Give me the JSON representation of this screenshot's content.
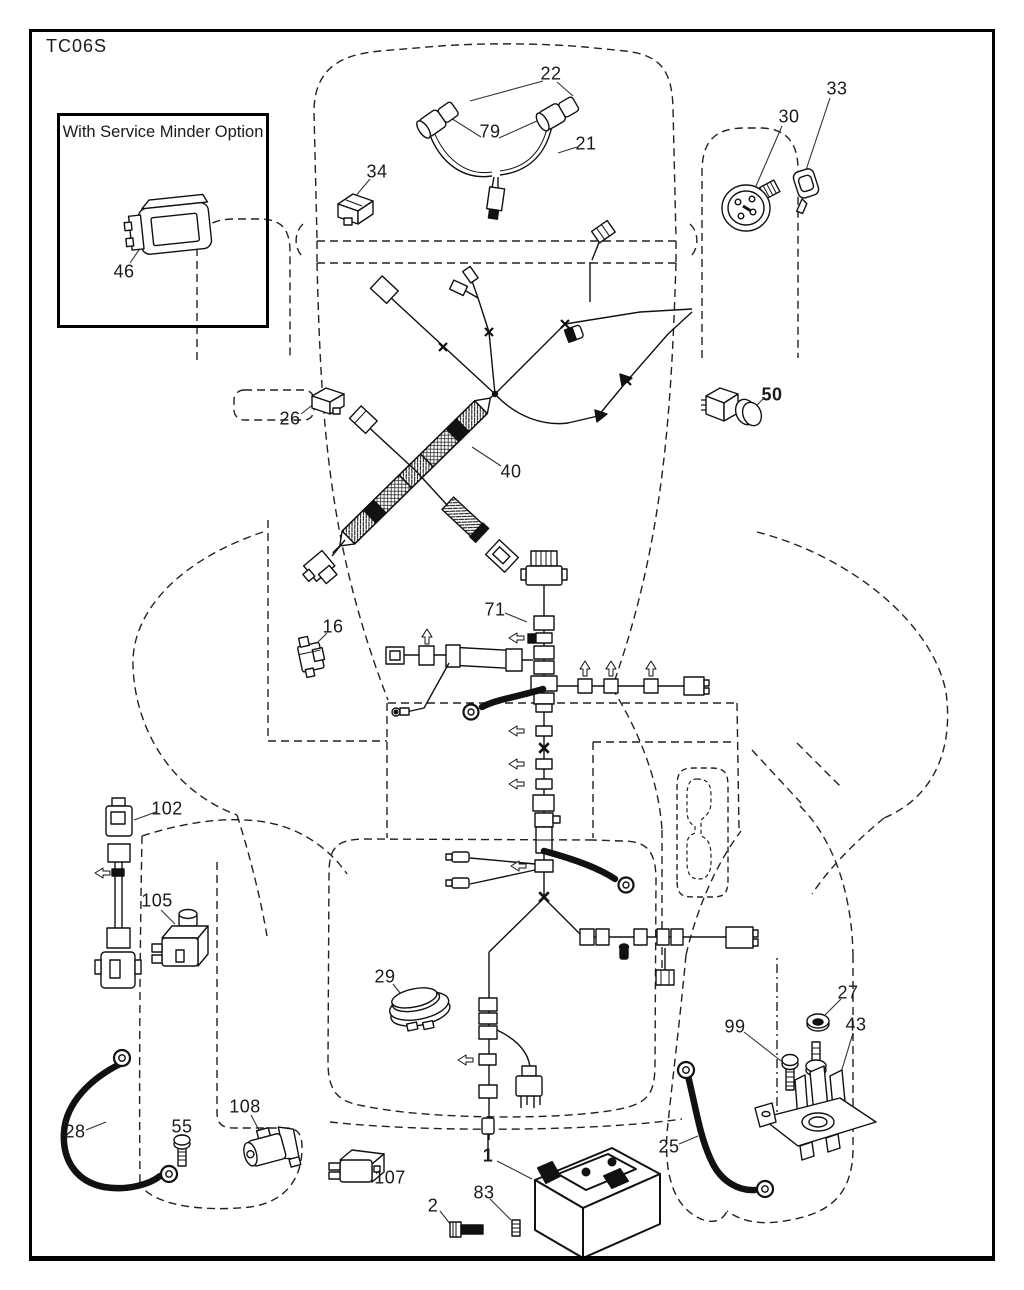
{
  "title": "TC06S",
  "inset": {
    "label": "With Service Minder Option",
    "part_number": "46"
  },
  "colors": {
    "line": "#1a1a1a",
    "background": "#ffffff"
  },
  "part_labels": [
    {
      "number": "22",
      "x": 551,
      "y": 74,
      "bold": false
    },
    {
      "number": "79",
      "x": 490,
      "y": 132,
      "bold": false
    },
    {
      "number": "21",
      "x": 586,
      "y": 144,
      "bold": false
    },
    {
      "number": "33",
      "x": 837,
      "y": 89,
      "bold": false
    },
    {
      "number": "30",
      "x": 789,
      "y": 117,
      "bold": false
    },
    {
      "number": "34",
      "x": 377,
      "y": 172,
      "bold": false
    },
    {
      "number": "46",
      "x": 124,
      "y": 272,
      "bold": false
    },
    {
      "number": "26",
      "x": 290,
      "y": 419,
      "bold": false
    },
    {
      "number": "40",
      "x": 511,
      "y": 472,
      "bold": false
    },
    {
      "number": "50",
      "x": 772,
      "y": 395,
      "bold": true
    },
    {
      "number": "71",
      "x": 495,
      "y": 610,
      "bold": false
    },
    {
      "number": "16",
      "x": 333,
      "y": 627,
      "bold": false
    },
    {
      "number": "102",
      "x": 167,
      "y": 809,
      "bold": false
    },
    {
      "number": "105",
      "x": 157,
      "y": 901,
      "bold": false
    },
    {
      "number": "29",
      "x": 385,
      "y": 977,
      "bold": false
    },
    {
      "number": "27",
      "x": 848,
      "y": 993,
      "bold": false
    },
    {
      "number": "43",
      "x": 856,
      "y": 1025,
      "bold": false
    },
    {
      "number": "99",
      "x": 735,
      "y": 1027,
      "bold": false
    },
    {
      "number": "25",
      "x": 669,
      "y": 1147,
      "bold": false
    },
    {
      "number": "28",
      "x": 75,
      "y": 1132,
      "bold": false
    },
    {
      "number": "55",
      "x": 182,
      "y": 1127,
      "bold": false
    },
    {
      "number": "108",
      "x": 245,
      "y": 1107,
      "bold": false
    },
    {
      "number": "107",
      "x": 390,
      "y": 1178,
      "bold": false
    },
    {
      "number": "1",
      "x": 488,
      "y": 1156,
      "bold": true
    },
    {
      "number": "2",
      "x": 433,
      "y": 1206,
      "bold": false
    },
    {
      "number": "83",
      "x": 484,
      "y": 1193,
      "bold": false
    }
  ]
}
